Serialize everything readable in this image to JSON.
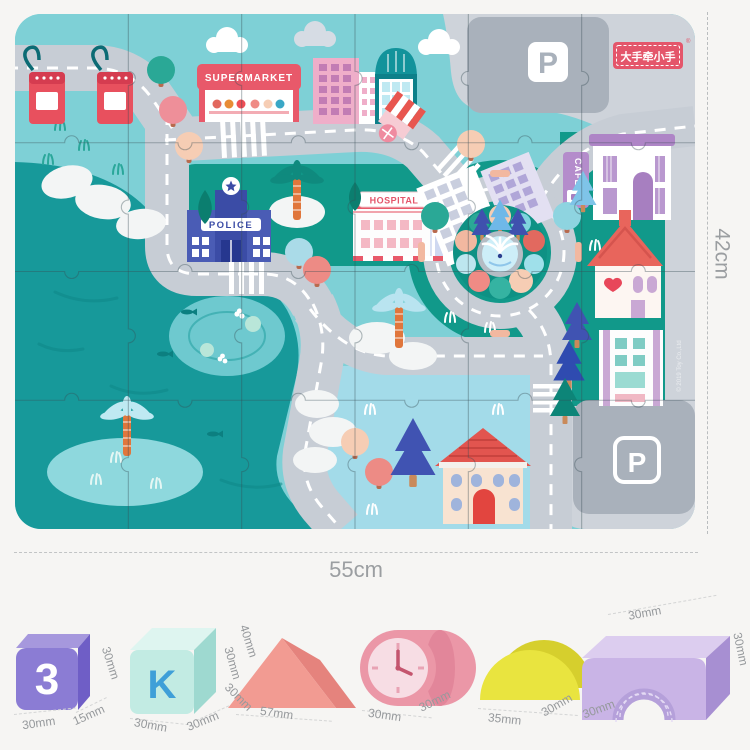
{
  "brand": {
    "logo_text": "大手牵小手",
    "registered": "®",
    "logo_bg": "#e4566b"
  },
  "mat": {
    "width_label": "55cm",
    "height_label": "42cm",
    "pieces": {
      "rows": 4,
      "cols": 6
    },
    "labels": {
      "supermarket": "SUPERMARKET",
      "police": "POLICE",
      "hospital": "HOSPITAL",
      "cafe": "CAFE",
      "parking_top": "P",
      "parking_bottom": "P",
      "copyright": "© 2019 Toy Co.,Ltd"
    }
  },
  "blocks": [
    {
      "id": "number-tile",
      "glyph": "3",
      "labels": {
        "right": "30mm",
        "bottom_left": "30mm",
        "bottom_right": "15mm"
      }
    },
    {
      "id": "letter-cube",
      "glyph": "K",
      "labels": {
        "right": "30mm",
        "bottom_left": "30mm",
        "bottom_right": "30mm"
      }
    },
    {
      "id": "triangle-prism",
      "labels": {
        "left_top": "40mm",
        "left_bottom": "30mm",
        "bottom": "57mm"
      }
    },
    {
      "id": "clock-cylinder",
      "labels": {
        "bottom_left": "30mm",
        "bottom_right": "30mm"
      }
    },
    {
      "id": "half-cylinder",
      "labels": {
        "bottom": "35mm",
        "bottom_right": "30mm"
      }
    },
    {
      "id": "arch-bridge",
      "labels": {
        "top": "30mm",
        "right": "30mm",
        "bottom_left": "30mm"
      }
    }
  ]
}
